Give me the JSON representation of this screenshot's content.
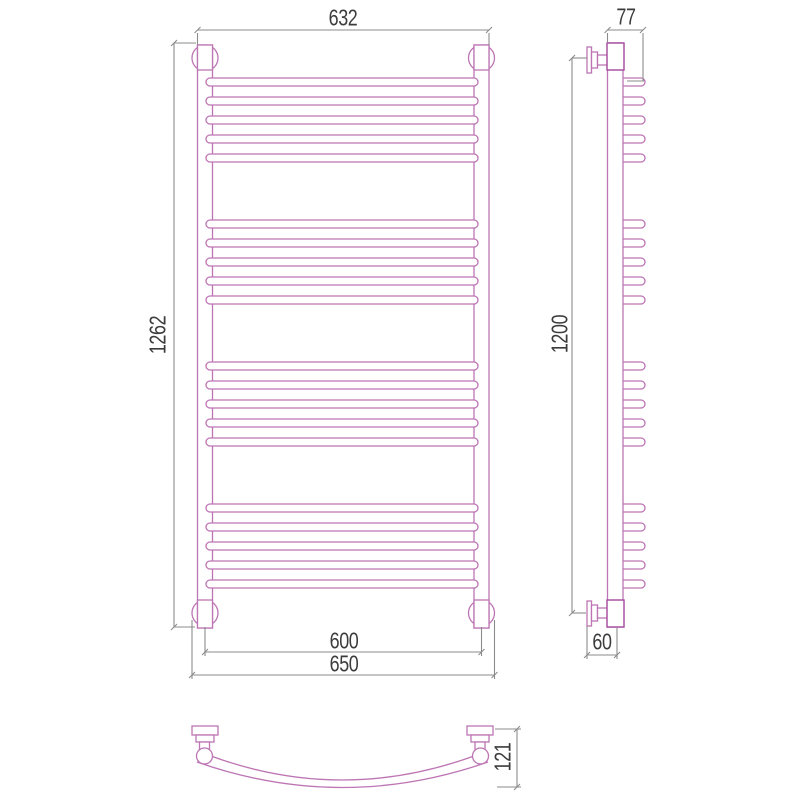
{
  "page": {
    "type": "technical-drawing",
    "subject": "curved ladder heated towel rail, three orthographic views",
    "background": "#ffffff"
  },
  "colors": {
    "outline_pink": "#bd75b4",
    "outline_dark_pink": "#a3489d",
    "dimension_gray": "#8b8b8b",
    "label_text": "#3c3c3c"
  },
  "views": {
    "front": {
      "name": "front-view",
      "bar_groups": 4,
      "bars_per_group": 5,
      "dims": {
        "top_width": "632",
        "height": "1262",
        "axis_width": "600",
        "overall_width": "650"
      }
    },
    "side": {
      "name": "side-view",
      "dims": {
        "top_depth": "77",
        "mount_height": "1200",
        "bottom_depth": "60"
      }
    },
    "plan": {
      "name": "plan-view",
      "dims": {
        "depth": "121"
      }
    }
  }
}
